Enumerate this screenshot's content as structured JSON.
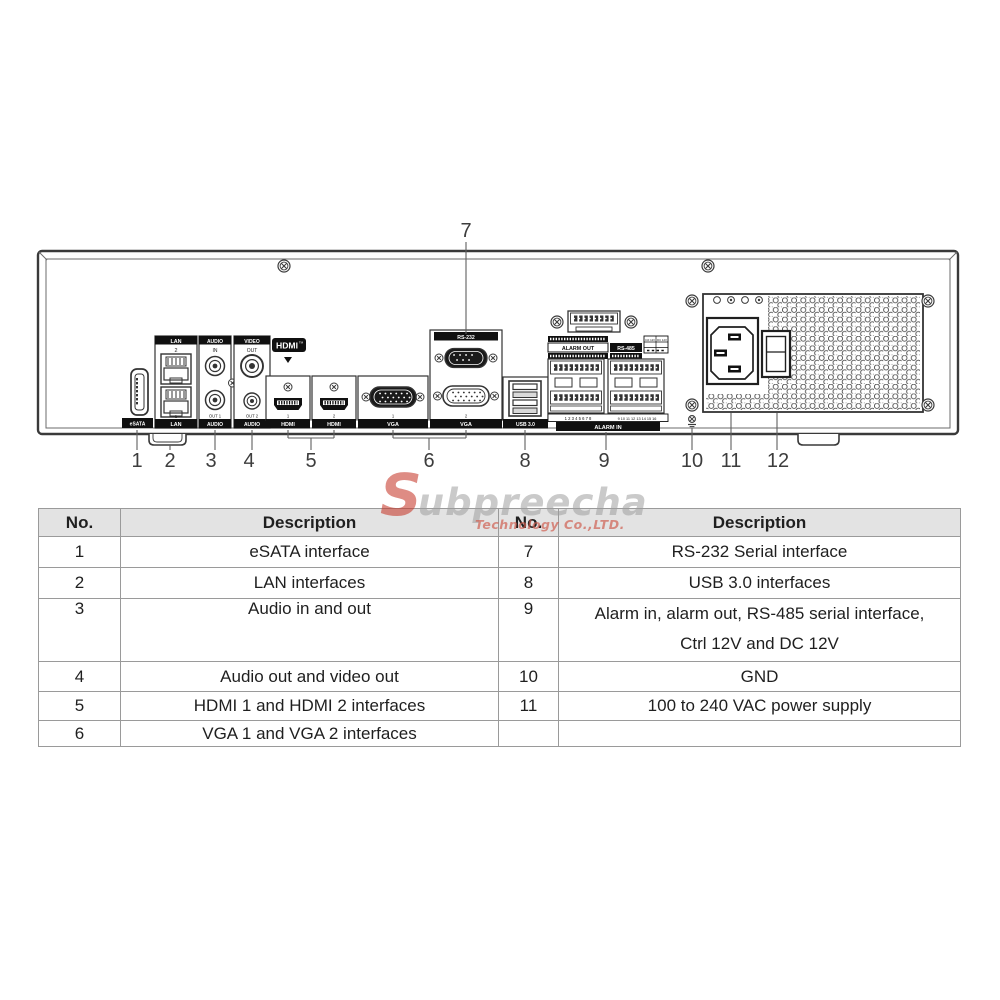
{
  "watermark": {
    "initial": "S",
    "rest": "ubpreecha",
    "subtitle": "Technology Co.,LTD.",
    "accent_red": "#c6392b",
    "accent_gray": "#9e9e9e"
  },
  "panel": {
    "ports": {
      "esata": "eSATA",
      "lan": "LAN",
      "num1": "1",
      "num2": "2",
      "audio": "AUDIO",
      "audio_in": "IN",
      "out1": "OUT 1",
      "out2": "OUT 2",
      "video": "VIDEO",
      "video_out": "OUT",
      "hdmi_logo": "HDMI",
      "hdmi_tm": "TM",
      "hdmi": "HDMI",
      "vga": "VGA",
      "rs232": "RS-232",
      "usb": "USB 3.0",
      "alarm_out": "ALARM OUT",
      "rs485": "RS-485",
      "alarm_in": "ALARM IN",
      "alarm_in_nums_left": "1 2 3 4 5 6 7 8",
      "alarm_in_nums_right": "9 10 11 12 13 14 15 16",
      "ctrl12v": "Ctrl 12V",
      "dc12v": "DC 12V"
    },
    "callouts": [
      "1",
      "2",
      "3",
      "4",
      "5",
      "6",
      "7",
      "8",
      "9",
      "10",
      "11",
      "12"
    ]
  },
  "table": {
    "left": {
      "headers": [
        "No.",
        "Description"
      ],
      "rows": [
        {
          "no": "1",
          "desc": "eSATA interface"
        },
        {
          "no": "2",
          "desc": "LAN interfaces"
        },
        {
          "no": "3",
          "desc": "Audio in and out"
        },
        {
          "no": "4",
          "desc": "Audio out and video out"
        },
        {
          "no": "5",
          "desc": "HDMI 1 and HDMI 2 interfaces"
        },
        {
          "no": "6",
          "desc": "VGA 1 and VGA 2 interfaces"
        }
      ]
    },
    "right": {
      "headers": [
        "No.",
        "Description"
      ],
      "rows": [
        {
          "no": "7",
          "desc": "RS-232 Serial interface"
        },
        {
          "no": "8",
          "desc": "USB 3.0 interfaces"
        },
        {
          "no": "9",
          "desc": "Alarm in, alarm out, RS-485 serial interface,\nCtrl 12V and DC 12V"
        },
        {
          "no": "10",
          "desc": "GND"
        },
        {
          "no": "11",
          "desc": "100 to 240 VAC power supply"
        },
        {
          "no": "",
          "desc": ""
        }
      ]
    }
  }
}
